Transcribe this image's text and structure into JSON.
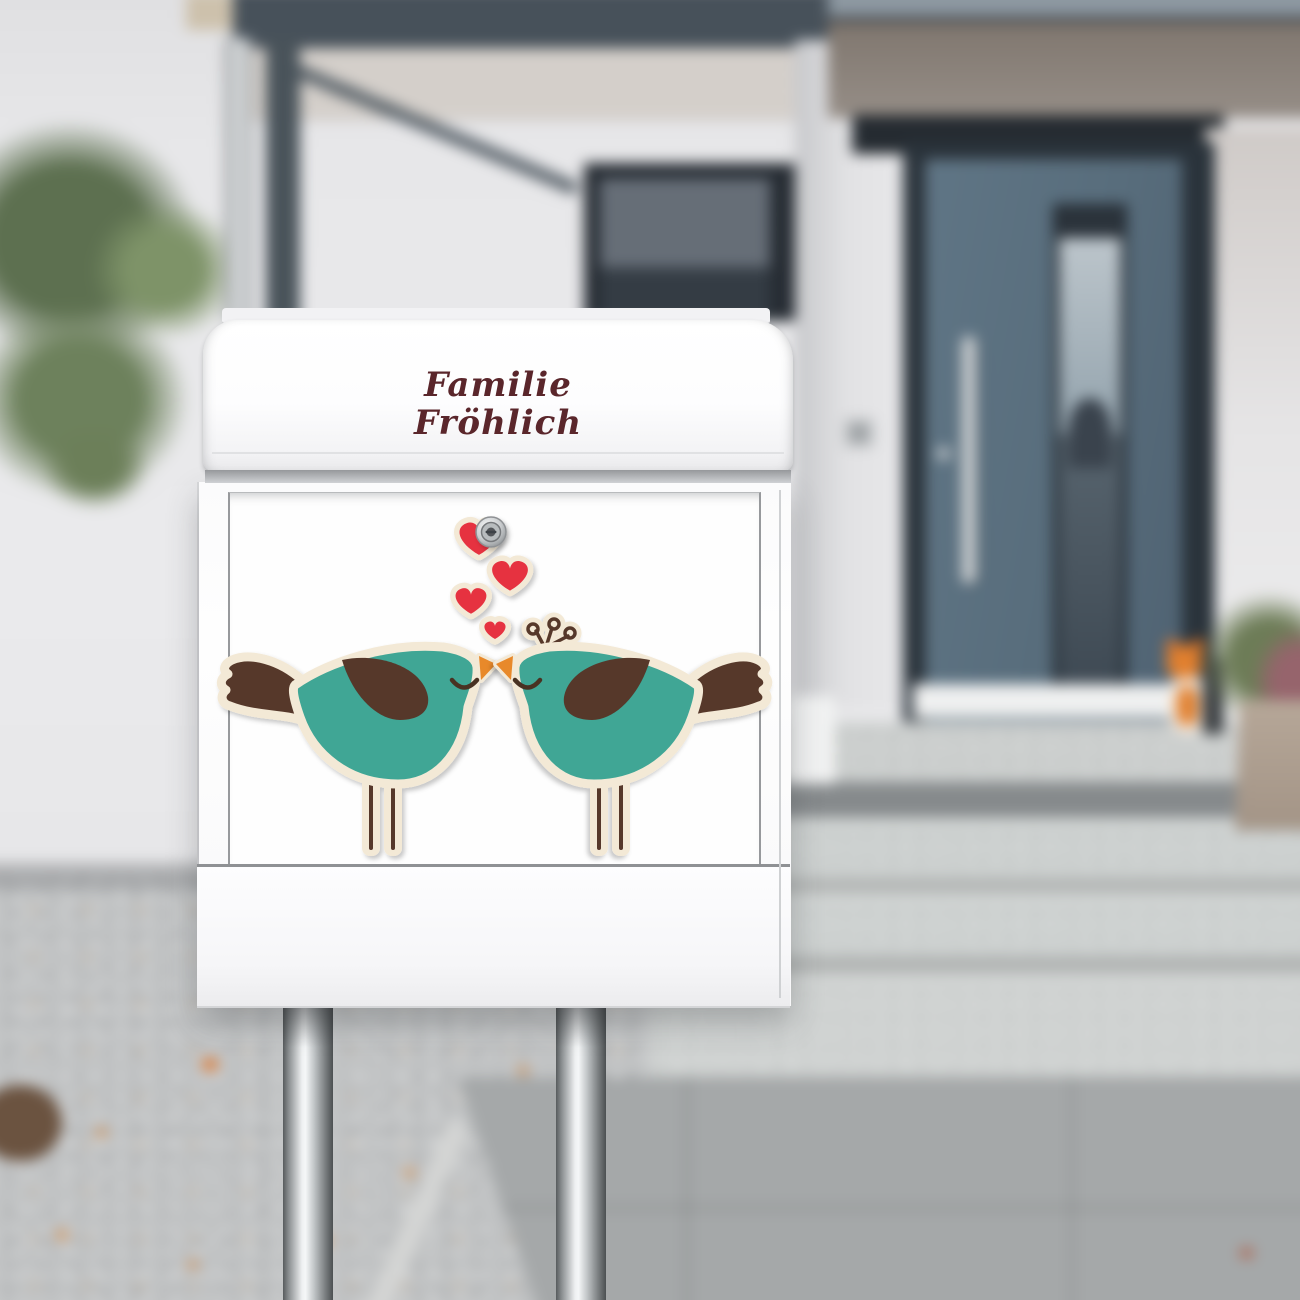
{
  "scene": {
    "kind": "product-photo",
    "subject": "white letterbox on steel posts with love-birds decal, in front of a blurred house entrance"
  },
  "nameplate": {
    "line1": "Familie",
    "line2": "Fröhlich",
    "text_color": "#5A262B"
  },
  "sticker": {
    "motif": "two kissing birds with four red hearts",
    "hearts_count": 4,
    "birds_count": 2,
    "colors": {
      "bird_teal": "#3FA695",
      "wing_brown": "#57382A",
      "outline_cream": "#F3E9D6",
      "heart_red": "#E6323F",
      "beak_orange": "#E8892B"
    }
  },
  "mailbox": {
    "body_color": "#FBFBFC",
    "stand_posts": 2,
    "lock": "cylinder-lock"
  },
  "environment": {
    "door_color": "#586D7C",
    "wall_color": "#E9E9EB",
    "steps_material": "granite",
    "fox_figurine_color": "#E1802F"
  }
}
